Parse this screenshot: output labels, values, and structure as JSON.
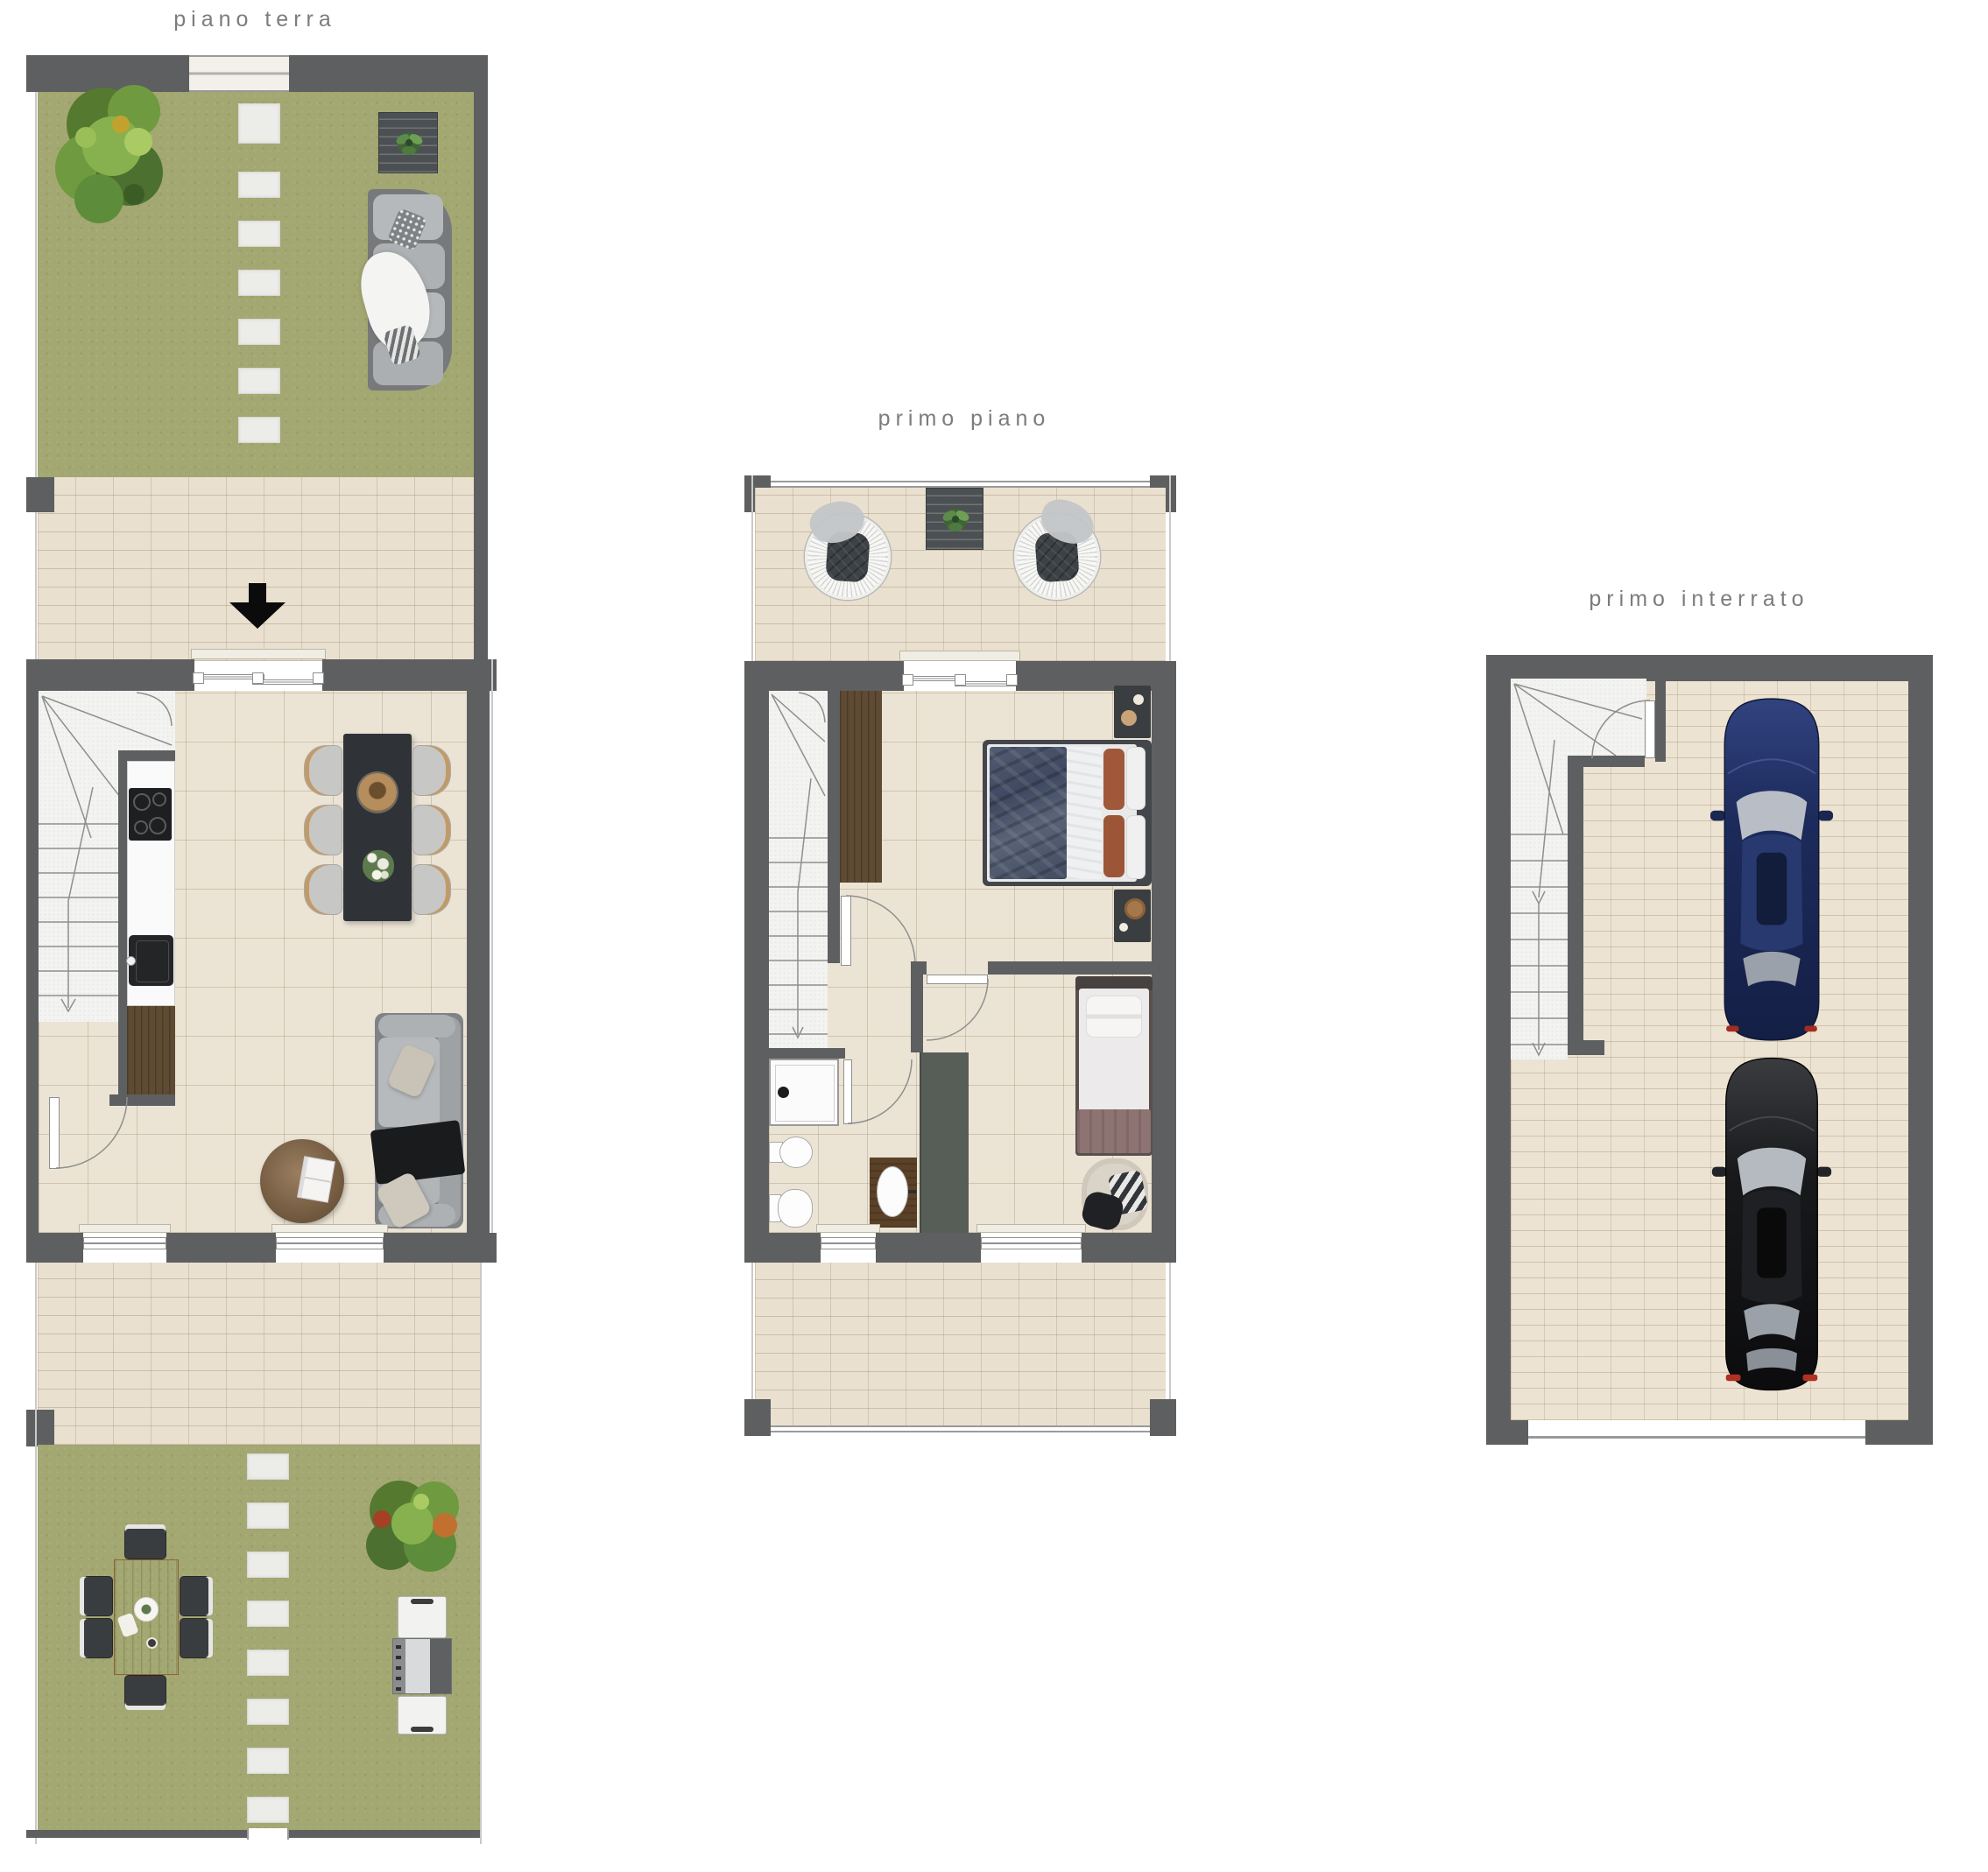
{
  "plans": [
    {
      "id": "piano-terra",
      "label": "piano terra"
    },
    {
      "id": "primo-piano",
      "label": "primo piano"
    },
    {
      "id": "primo-interrato",
      "label": "primo interrato"
    }
  ],
  "palette": {
    "wall_gray": "#5e5f60",
    "grass_green": "#a3a771",
    "paving_beige": "#e9e0cf",
    "tile_floor_cream": "#ebe4d5",
    "stair_white": "#f3f3f1",
    "wood_dark": "#5f4b33",
    "wood_warm": "#c08a52",
    "kitchen_counter_white": "#fafafa",
    "appliance_black": "#1e1f21",
    "dining_table_black": "#2f3236",
    "sofa_gray": "#b7babc",
    "bed_blanket_navy": "#49536a",
    "pillow_rust": "#a0583a",
    "bed_blanket_mauve": "#8d7472",
    "closet_gray_green": "#575e57",
    "car_blue": "#1d2b5c",
    "car_black": "#141517",
    "entrance_arrow_black": "#0b0b0b",
    "label_text_gray": "#7c7c7c"
  }
}
